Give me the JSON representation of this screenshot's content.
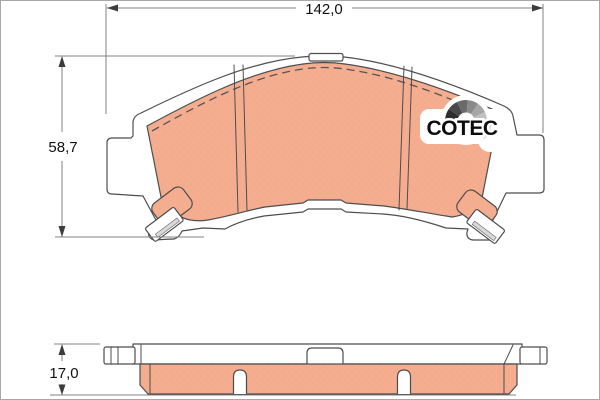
{
  "dimensions": {
    "width": {
      "label": "142,0"
    },
    "height": {
      "label": "58,7"
    },
    "thickness": {
      "label": "17,0"
    }
  },
  "logo": {
    "text": "COTEC",
    "segments": [
      "#2e2e2e",
      "#484848",
      "#6a6a6a",
      "#8a8a8a",
      "#a6a6a6",
      "#c1c1c1",
      "#dcdcdc"
    ]
  },
  "colors": {
    "friction": "#f5ad90",
    "outline": "#4d4d4d",
    "dimension": "#808080",
    "label": "#111111"
  }
}
